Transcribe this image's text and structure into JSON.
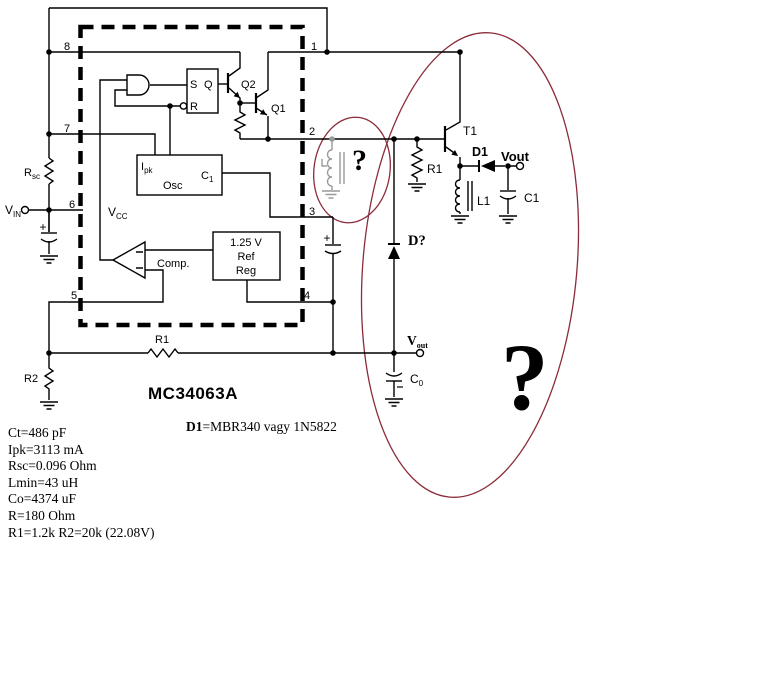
{
  "colors": {
    "wire": "#000000",
    "disabled_gray": "#9a9a9a",
    "ellipse_red": "#8b2c3a",
    "question_red_small": "#8e1322",
    "question_red_big": "#7d1120",
    "navy": "#00004f"
  },
  "title": {
    "ic_name": "MC34063A"
  },
  "notes": {
    "d1_bold": "D1",
    "d1_rest": "=MBR340 vagy 1N5822"
  },
  "params": [
    "Ct=486 pF",
    "Ipk=3113 mA",
    "Rsc=0.096 Ohm",
    "Lmin=43 uH",
    "Co=4374 uF",
    "R=180 Ohm",
    "R1=1.2k R2=20k (22.08V)"
  ],
  "pins": {
    "p1": "1",
    "p2": "2",
    "p3": "3",
    "p4": "4",
    "p5": "5",
    "p6": "6",
    "p7": "7",
    "p8": "8"
  },
  "ic": {
    "latch_s": "S",
    "latch_q": "Q",
    "latch_r": "R",
    "osc_i": "I",
    "osc_i_sub": "pk",
    "osc": "Osc",
    "osc_c": "C",
    "osc_c_sub": "1",
    "ref1": "1.25 V",
    "ref2": "Ref",
    "ref3": "Reg",
    "comp": "Comp.",
    "vcc": "V",
    "vcc_sub": "CC",
    "q1": "Q1",
    "q2": "Q2"
  },
  "left": {
    "rsc": "R",
    "rsc_sub": "sc",
    "vin": "V",
    "vin_sub": "IN",
    "plus": "+",
    "r2": "R2"
  },
  "feedback": {
    "r1": "R1",
    "vout": "V",
    "vout_sub": "out",
    "c0": "C",
    "c0_sub": "0"
  },
  "external": {
    "t1": "T1",
    "r1": "R1",
    "l1": "L1",
    "c1": "C1",
    "d1_label": "D1",
    "vout": "Vout",
    "d_unknown": "D?",
    "q_small": "?",
    "q_big": "?",
    "ct_plus": "+"
  }
}
